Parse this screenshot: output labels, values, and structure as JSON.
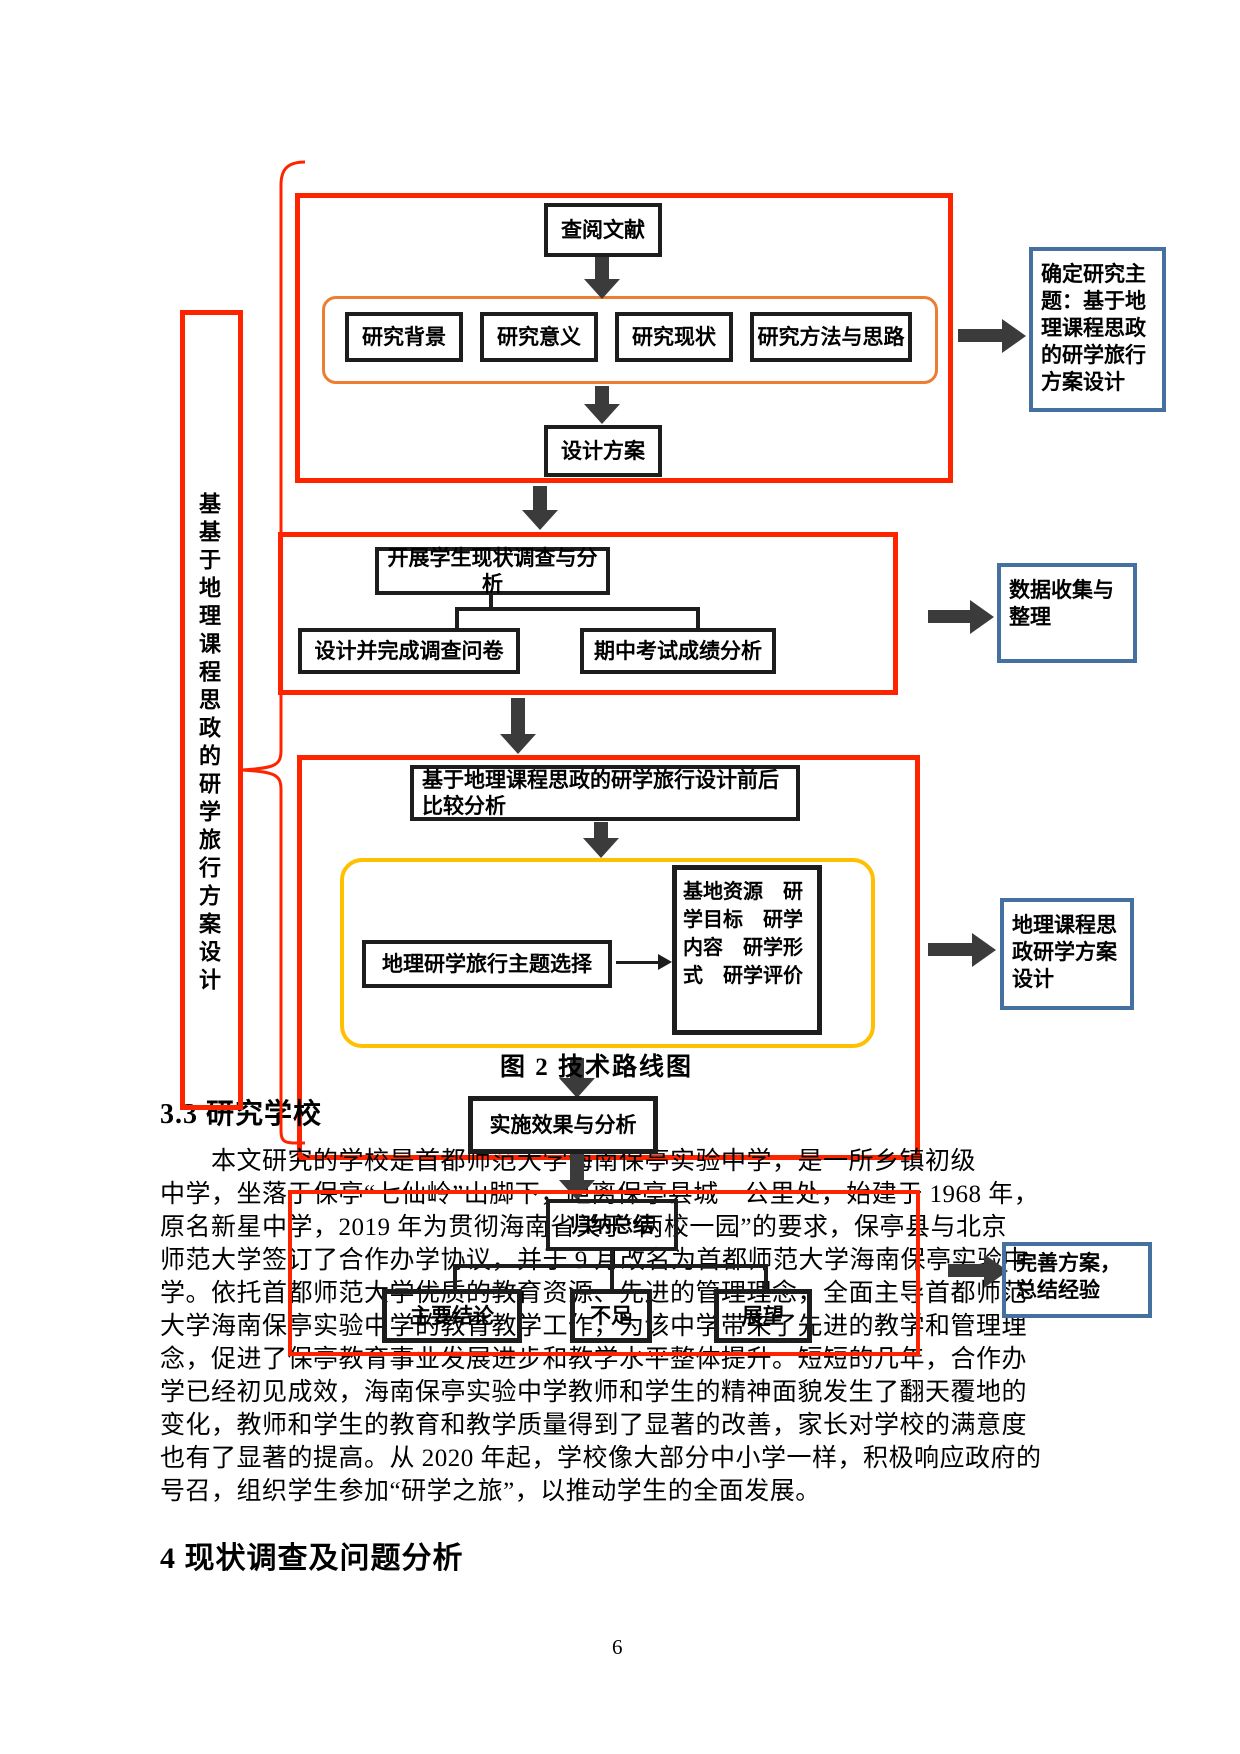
{
  "page_number": "6",
  "headings": {
    "s33": "3.3 研究学校",
    "s4": "4 现状调查及问题分析"
  },
  "figure_caption": "图 2 技术路线图",
  "flowchart": {
    "side_label": "基基于地理课程思政的研学旅行方案设计",
    "stage1": {
      "literature": "查阅文献",
      "aspects": [
        "研究背景",
        "研究意义",
        "研究现状",
        "研究方法与思路"
      ],
      "design": "设计方案",
      "outcome": "确定研究主题：基于地理课程思政的研学旅行方案设计"
    },
    "stage2": {
      "survey": "开展学生现状调查与分析",
      "questionnaire": "设计并完成调查问卷",
      "exam": "期中考试成绩分析",
      "outcome": "数据收集与整理"
    },
    "stage3": {
      "compare": "基于地理课程思政的研学旅行设计前后比较分析",
      "theme": "地理研学旅行主题选择",
      "elements": "基地资源　研学目标　研学内容　研学形式　研学评价",
      "outcome": "地理课程思政研学方案设计",
      "implementation": "实施效果与分析"
    },
    "stage4": {
      "summary": "归纳总结",
      "conclusion": "主要结论",
      "limitation": "不足",
      "prospect": "展望",
      "outcome": "完善方案，总结经验"
    }
  },
  "paragraph_lines": [
    "　　本文研究的学校是首都师范大学海南保亭实验中学，是一所乡镇初级",
    "中学，坐落于保亭“七仙岭”山脚下，距离保亭县城一公里处，始建于 1968 年，",
    "原名新星中学，2019 年为贯彻海南省关于“两校一园”的要求，保亭县与北京",
    "师范大学签订了合作办学协议，并于 9 月改名为首都师范大学海南保亭实验中",
    "学。依托首都师范大学优质的教育资源、先进的管理理念，全面主导首都师范",
    "大学海南保亭实验中学的教育教学工作，为该中学带来了先进的教学和管理理",
    "念，促进了保亭教育事业发展进步和教学水平整体提升。短短的几年，合作办",
    "学已经初见成效，海南保亭实验中学教师和学生的精神面貌发生了翻天覆地的",
    "变化，教师和学生的教育和教学质量得到了显著的改善，家长对学校的满意度",
    "也有了显著的提高。从 2020 年起，学校像大部分中小学一样，积极响应政府的",
    "号召，组织学生参加“研学之旅”，以推动学生的全面发展。"
  ],
  "colors": {
    "red": "#FF2400",
    "orange": "#ED7D31",
    "yellow": "#FFC000",
    "blue": "#44719F",
    "arrow": "#3B3B3B",
    "ink": "#1D1D1D"
  }
}
